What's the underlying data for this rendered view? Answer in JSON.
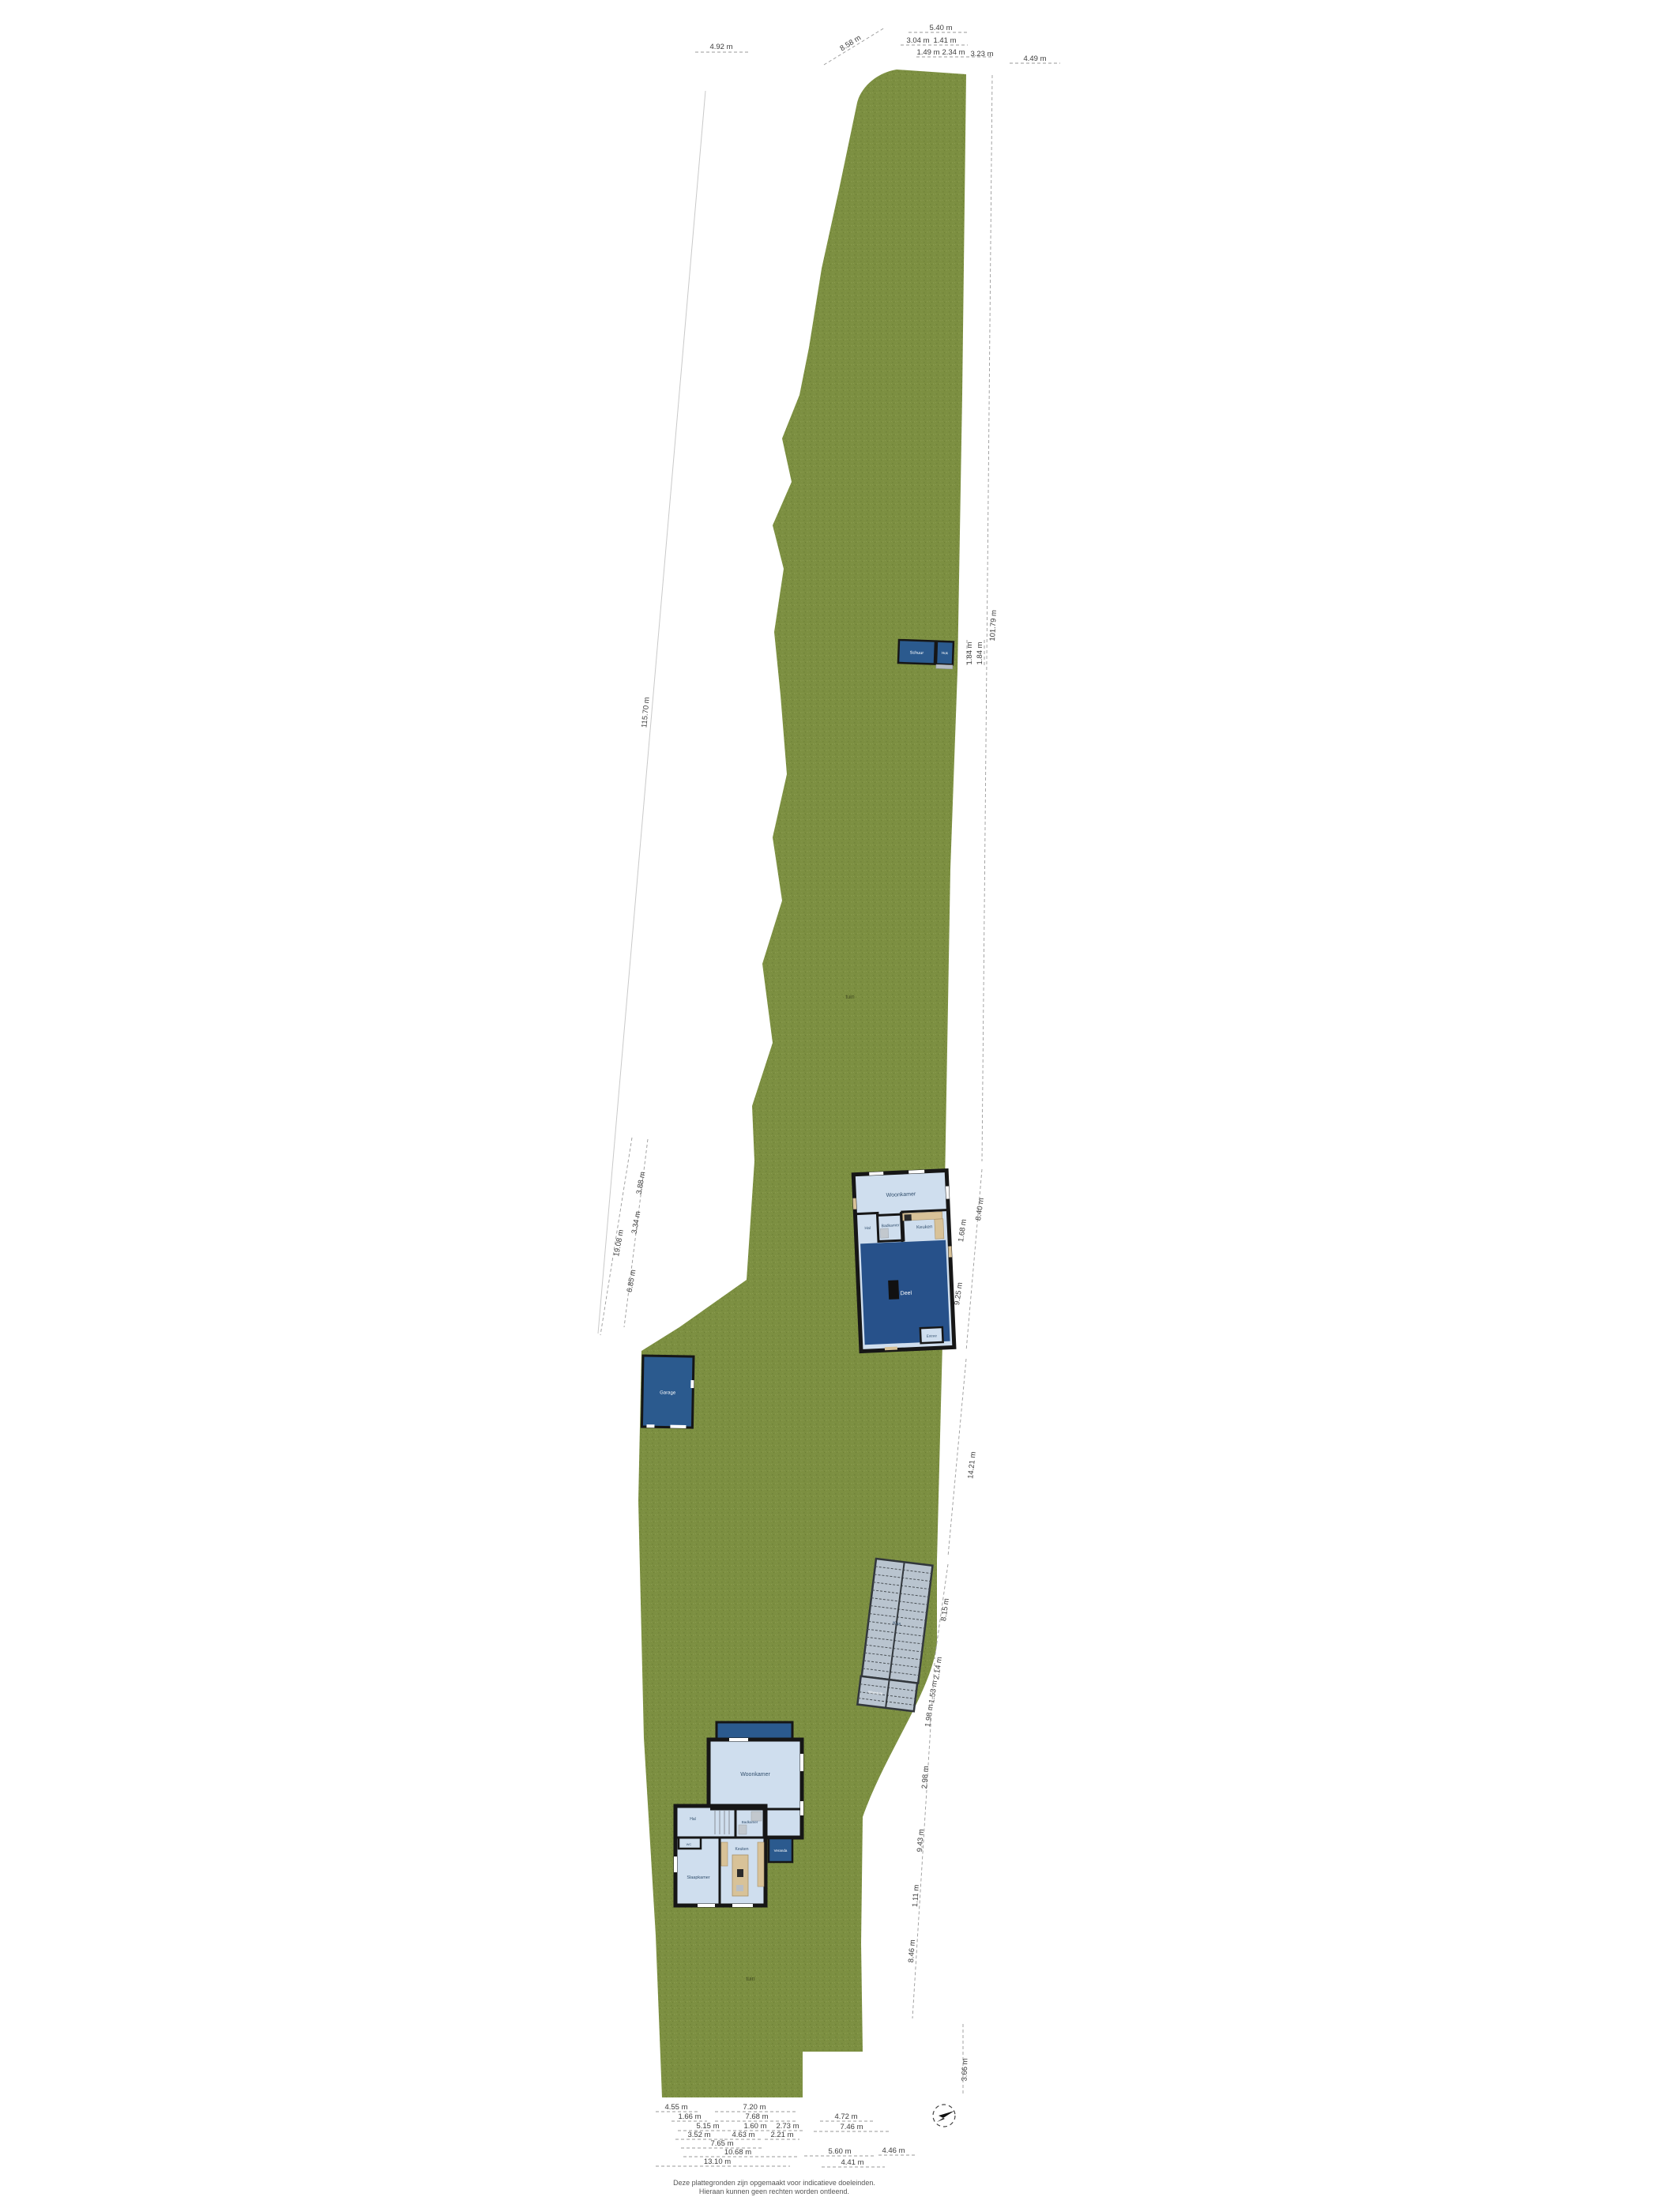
{
  "site": {
    "ground_label_1": "tuin",
    "ground_label_2": "tuin",
    "disclaimer_line1": "Deze plattegronden zijn opgemaakt voor indicatieve doeleinden.",
    "disclaimer_line2": "Hieraan kunnen geen rechten worden ontleend."
  },
  "colors": {
    "grass": "#7c8f41",
    "roof_blue": "#2b5a8e",
    "barn_blue": "#27518a",
    "room_blue": "#cfdeee",
    "wall": "#161616",
    "furniture": "#d8c298",
    "greenhouse_glass": "#b9c4cf"
  },
  "buildings": {
    "shed": {
      "left": "Schuur",
      "right": "Hok"
    },
    "garage": {
      "label": "Garage"
    },
    "house1": {
      "living": "Woonkamer",
      "kitchen": "Keuken",
      "bath": "Badkamer",
      "hall": "Hal",
      "barn": "Deel",
      "entry": "Entree"
    },
    "greenhouse": {
      "label": "Kas",
      "annex": "Moestuin"
    },
    "house2": {
      "living": "Woonkamer",
      "bath": "Badkamer",
      "hall": "Hal",
      "wc": "WC",
      "bedroom": "Slaapkamer",
      "kitchen": "Keuken",
      "veranda": "Veranda"
    }
  },
  "dims": {
    "top": [
      "4.92 m",
      "8.58 m",
      "5.40 m",
      "3.04 m",
      "1.41 m",
      "1.49 m",
      "2.34 m",
      "3.23 m",
      "4.49 m"
    ],
    "left": [
      "115.70 m",
      "19.08 m",
      "3.88 m",
      "3.34 m",
      "6.85 m"
    ],
    "right": [
      "101.79 m",
      "1.84 m",
      "1.84 m",
      "8.40 m",
      "1.68 m",
      "9.25 m",
      "14.21 m",
      "8.15 m",
      "2.14 m",
      "1.53 m",
      "1.98 m",
      "2.98 m",
      "9.43 m",
      "1.11 m",
      "8.46 m",
      "3.66 m"
    ],
    "bottom": [
      "4.55 m",
      "7.20 m",
      "1.66 m",
      "7.68 m",
      "4.72 m",
      "5.15 m",
      "1.60 m",
      "2.73 m",
      "7.46 m",
      "3.52 m",
      "4.63 m",
      "2.21 m",
      "7.65 m",
      "10.68 m",
      "5.60 m",
      "4.46 m",
      "13.10 m",
      "4.41 m"
    ]
  }
}
